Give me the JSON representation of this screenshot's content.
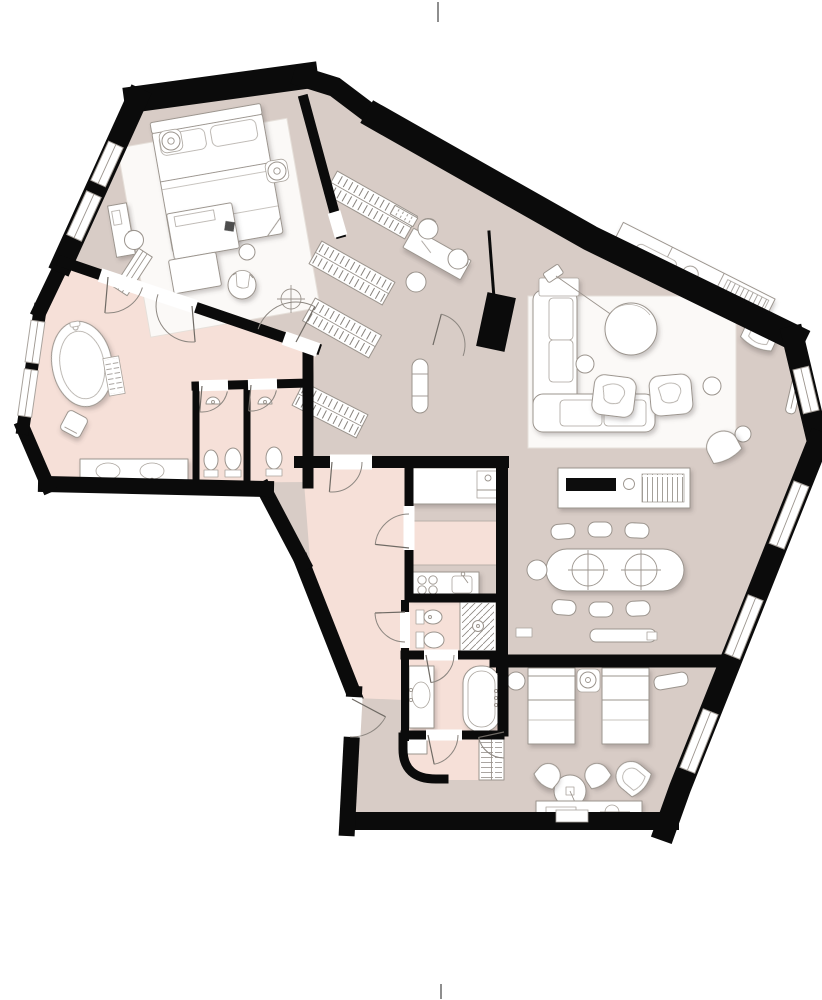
{
  "meta": {
    "kind": "architectural-floor-plan",
    "view": "top-down",
    "text_labels": [],
    "style": "rendered plan with soft furniture shadows, no dimensions or room names printed"
  },
  "palette": {
    "background": "#ffffff",
    "wall": "#0b0b0b",
    "floor_main": "#d8ccc6",
    "floor_wet": "#f6e0d8",
    "furniture_fill": "#ffffff",
    "furniture_line": "#9b948d",
    "rug": "#fbf9f7",
    "appliance_black": "#111111",
    "hatch_line": "#7a746e"
  },
  "structure": {
    "wall_style": "solid black poche, irregular rotated footprint",
    "window_count": 8,
    "door_count": 12,
    "column_count": 1,
    "ceiling_light_symbols": 1,
    "print_marks": [
      "top-center tick",
      "bottom-center tick"
    ]
  },
  "rooms": [
    {
      "id": "master-bedroom",
      "floor": "floor_main",
      "furniture": [
        "king bed with headboard and 2 pillows",
        "round nightstand with lamp x2",
        "large area rug",
        "foot ottoman with throw",
        "bench",
        "round lounge chair",
        "small side table",
        "window desk with chair",
        "leaning ladder rack",
        "ceiling light symbol"
      ]
    },
    {
      "id": "dressing-corridor",
      "floor": "floor_main",
      "furniture": [
        "wardrobe hanging rack x2"
      ]
    },
    {
      "id": "study-nook",
      "floor": "floor_main",
      "furniture": [
        "desk",
        "desk chair x3",
        "wall shelf vent"
      ]
    },
    {
      "id": "hall",
      "floor": "floor_main",
      "furniture": [
        "wardrobe hanging rack x2",
        "luggage console",
        "structural column"
      ]
    },
    {
      "id": "master-bathroom",
      "floor": "floor_wet",
      "furniture": [
        "freestanding oval bathtub",
        "bath mat",
        "stool",
        "double vanity with 2 sinks"
      ]
    },
    {
      "id": "wc-1",
      "floor": "floor_wet",
      "furniture": [
        "bidet",
        "toilet",
        "wall basin"
      ]
    },
    {
      "id": "wc-2",
      "floor": "floor_wet",
      "furniture": [
        "toilet",
        "wall basin"
      ]
    },
    {
      "id": "living-room",
      "floor": "floor_main",
      "furniture": [
        "corner sofa",
        "round coffee table",
        "arc floor lamp",
        "lounge chair x2",
        "large rug",
        "side table x2",
        "long sideboard along wall",
        "lounge armchair",
        "floor lamp",
        "pouf",
        "curved bench",
        "radiator"
      ]
    },
    {
      "id": "dining-area",
      "floor": "floor_main",
      "furniture": [
        "oval dining table with 2 turntables",
        "dining chair x6",
        "end chair",
        "credenza with black tray and vent grille",
        "radiator bench",
        "wall switch box x2"
      ]
    },
    {
      "id": "kitchen",
      "floor": "floor_main",
      "furniture": [
        "wall counter with built-in appliance",
        "pink island counter",
        "base counter with 4-burner cooktop",
        "sink with faucet"
      ]
    },
    {
      "id": "shower-room",
      "floor": "floor_wet",
      "furniture": [
        "bidet",
        "toilet",
        "walk-in shower with drain"
      ]
    },
    {
      "id": "second-bathroom",
      "floor": "floor_wet",
      "furniture": [
        "vanity with oval sink",
        "built-in bathtub",
        "drawer chest",
        "low cabinet",
        "curved corridor wall"
      ]
    },
    {
      "id": "bedroom-2",
      "floor": "floor_main",
      "furniture": [
        "single bed x2",
        "shared nightstand with lamp",
        "pouf",
        "radiator bench",
        "round table with pendant lamp",
        "tub chair x2",
        "lounge armchair",
        "console sideboard with tray"
      ]
    },
    {
      "id": "entry-hall",
      "floor": "floor_main",
      "furniture": [
        "entrance door",
        "threshold niche"
      ]
    }
  ]
}
